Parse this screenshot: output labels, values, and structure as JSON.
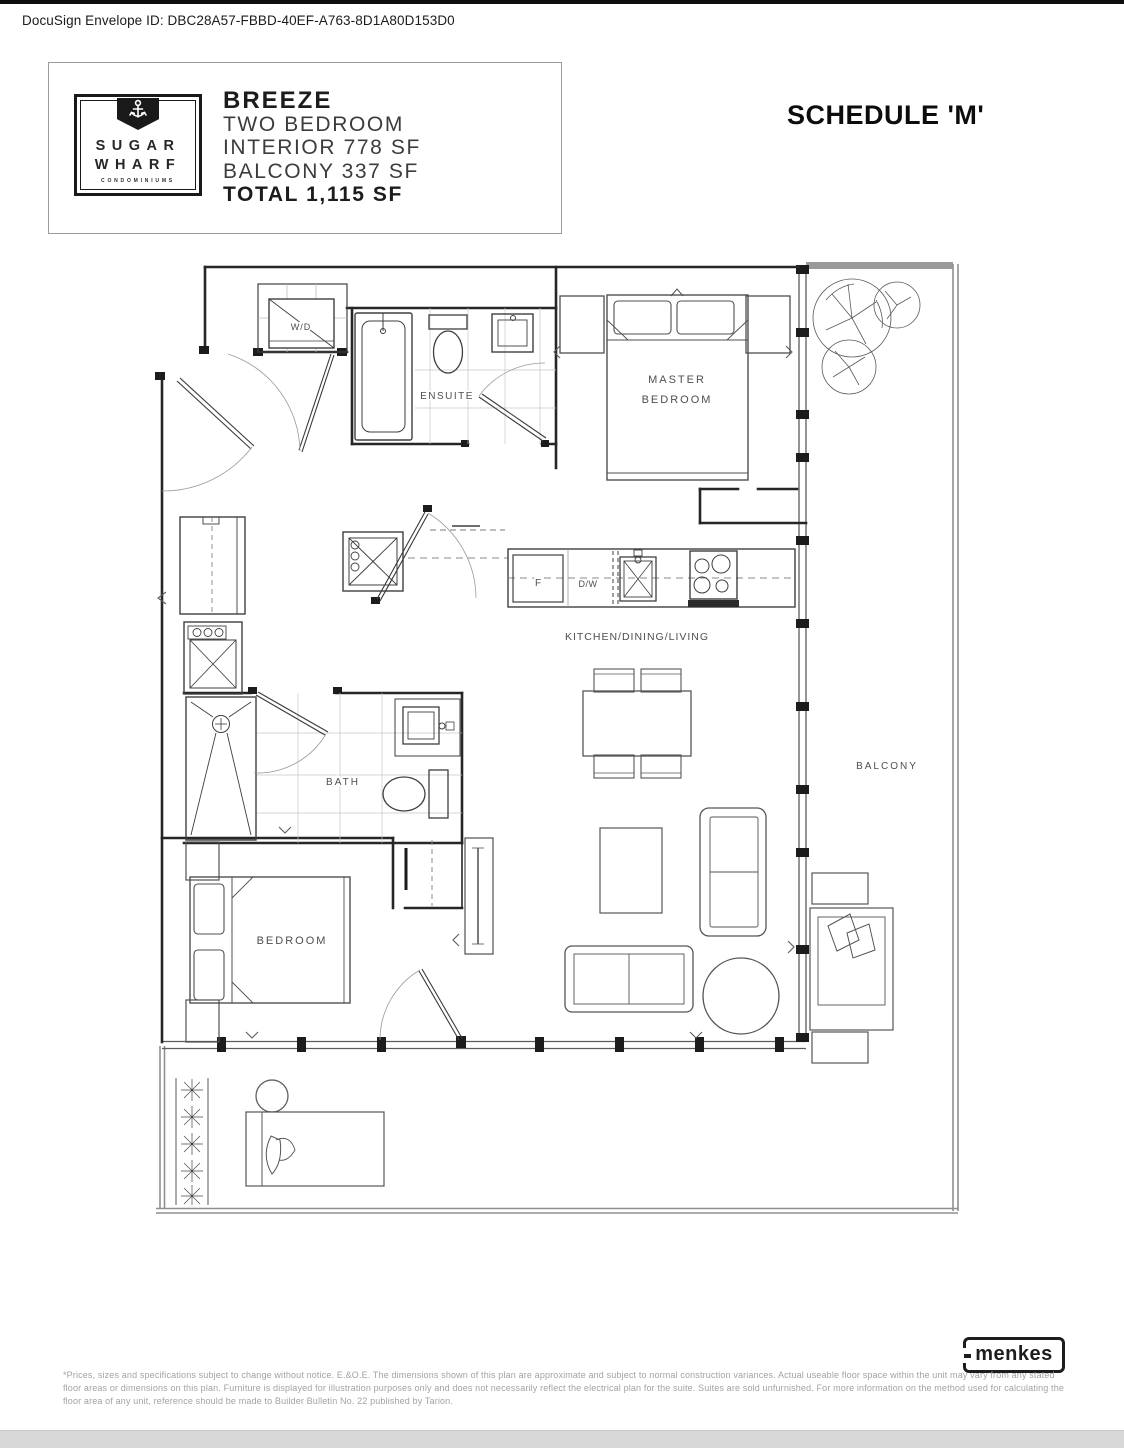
{
  "docusign": {
    "text": "DocuSign Envelope ID: DBC28A57-FBBD-40EF-A763-8D1A80D153D0"
  },
  "header": {
    "logo": {
      "anchor_icon": "⚓",
      "line1": "SUGAR",
      "line2": "WHARF",
      "line3": "CONDOMINIUMS"
    },
    "plan": {
      "name": "BREEZE",
      "type": "TWO BEDROOM",
      "interior": "INTERIOR 778 SF",
      "balcony": "BALCONY 337 SF",
      "total": "TOTAL 1,115 SF"
    },
    "schedule_title": "SCHEDULE 'M'"
  },
  "floorplan": {
    "labels": {
      "wd": "W/D",
      "ensuite": "ENSUITE",
      "master_line1": "MASTER",
      "master_line2": "BEDROOM",
      "fridge": "F",
      "dishwasher": "D/W",
      "kitchen": "KITCHEN/DINING/LIVING",
      "bath": "BATH",
      "bedroom": "BEDROOM",
      "balcony": "BALCONY"
    }
  },
  "footer": {
    "brand": "menkes",
    "disclaimer": "*Prices, sizes and specifications subject to change without notice. E.&O.E. The dimensions shown of this plan are approximate and subject to normal construction variances. Actual useable floor space within the unit may vary from any stated floor areas or dimensions on this plan. Furniture is displayed for illustration purposes only and does not necessarily reflect the electrical plan for the suite. Suites are sold unfurnished. For more information on the method used for calculating the floor area of any unit, reference should be made to Builder Bulletin No. 22 published by Tarion.",
    "colors": {
      "wall": "#262626",
      "balcony_wall": "#8f8f8f",
      "label": "#4e4e4e"
    }
  }
}
